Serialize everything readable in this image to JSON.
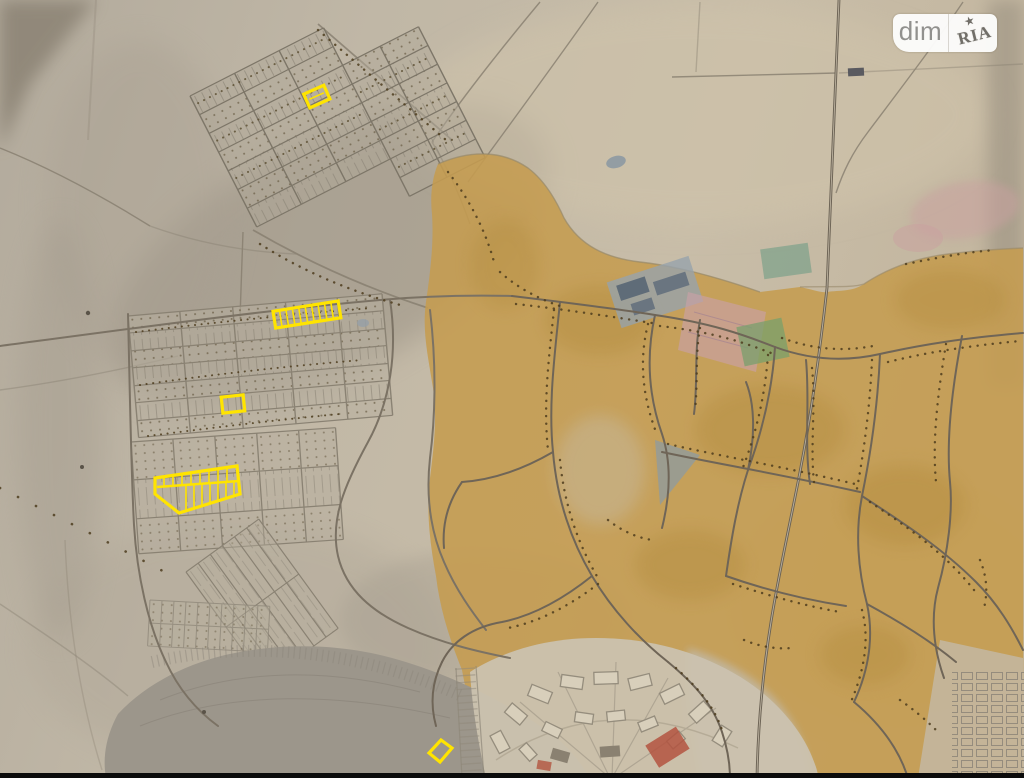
{
  "watermark": {
    "left_label": "dim",
    "right_label": "RIA",
    "star_glyph": "★"
  },
  "map": {
    "highlight_color": "#ffe400",
    "paper_color_left": "#b2aa9c",
    "paper_color_right": "#c8bca6",
    "urban_fill": "#c59c50",
    "water_fill": "#9c968b",
    "road_stroke": "#6f6557",
    "field_line_stroke": "#867e6f",
    "tree_dot_stroke": "#4e3d1e",
    "railway_stroke": "#6b6254",
    "bottom_bar_color": "#0b0b0b"
  }
}
